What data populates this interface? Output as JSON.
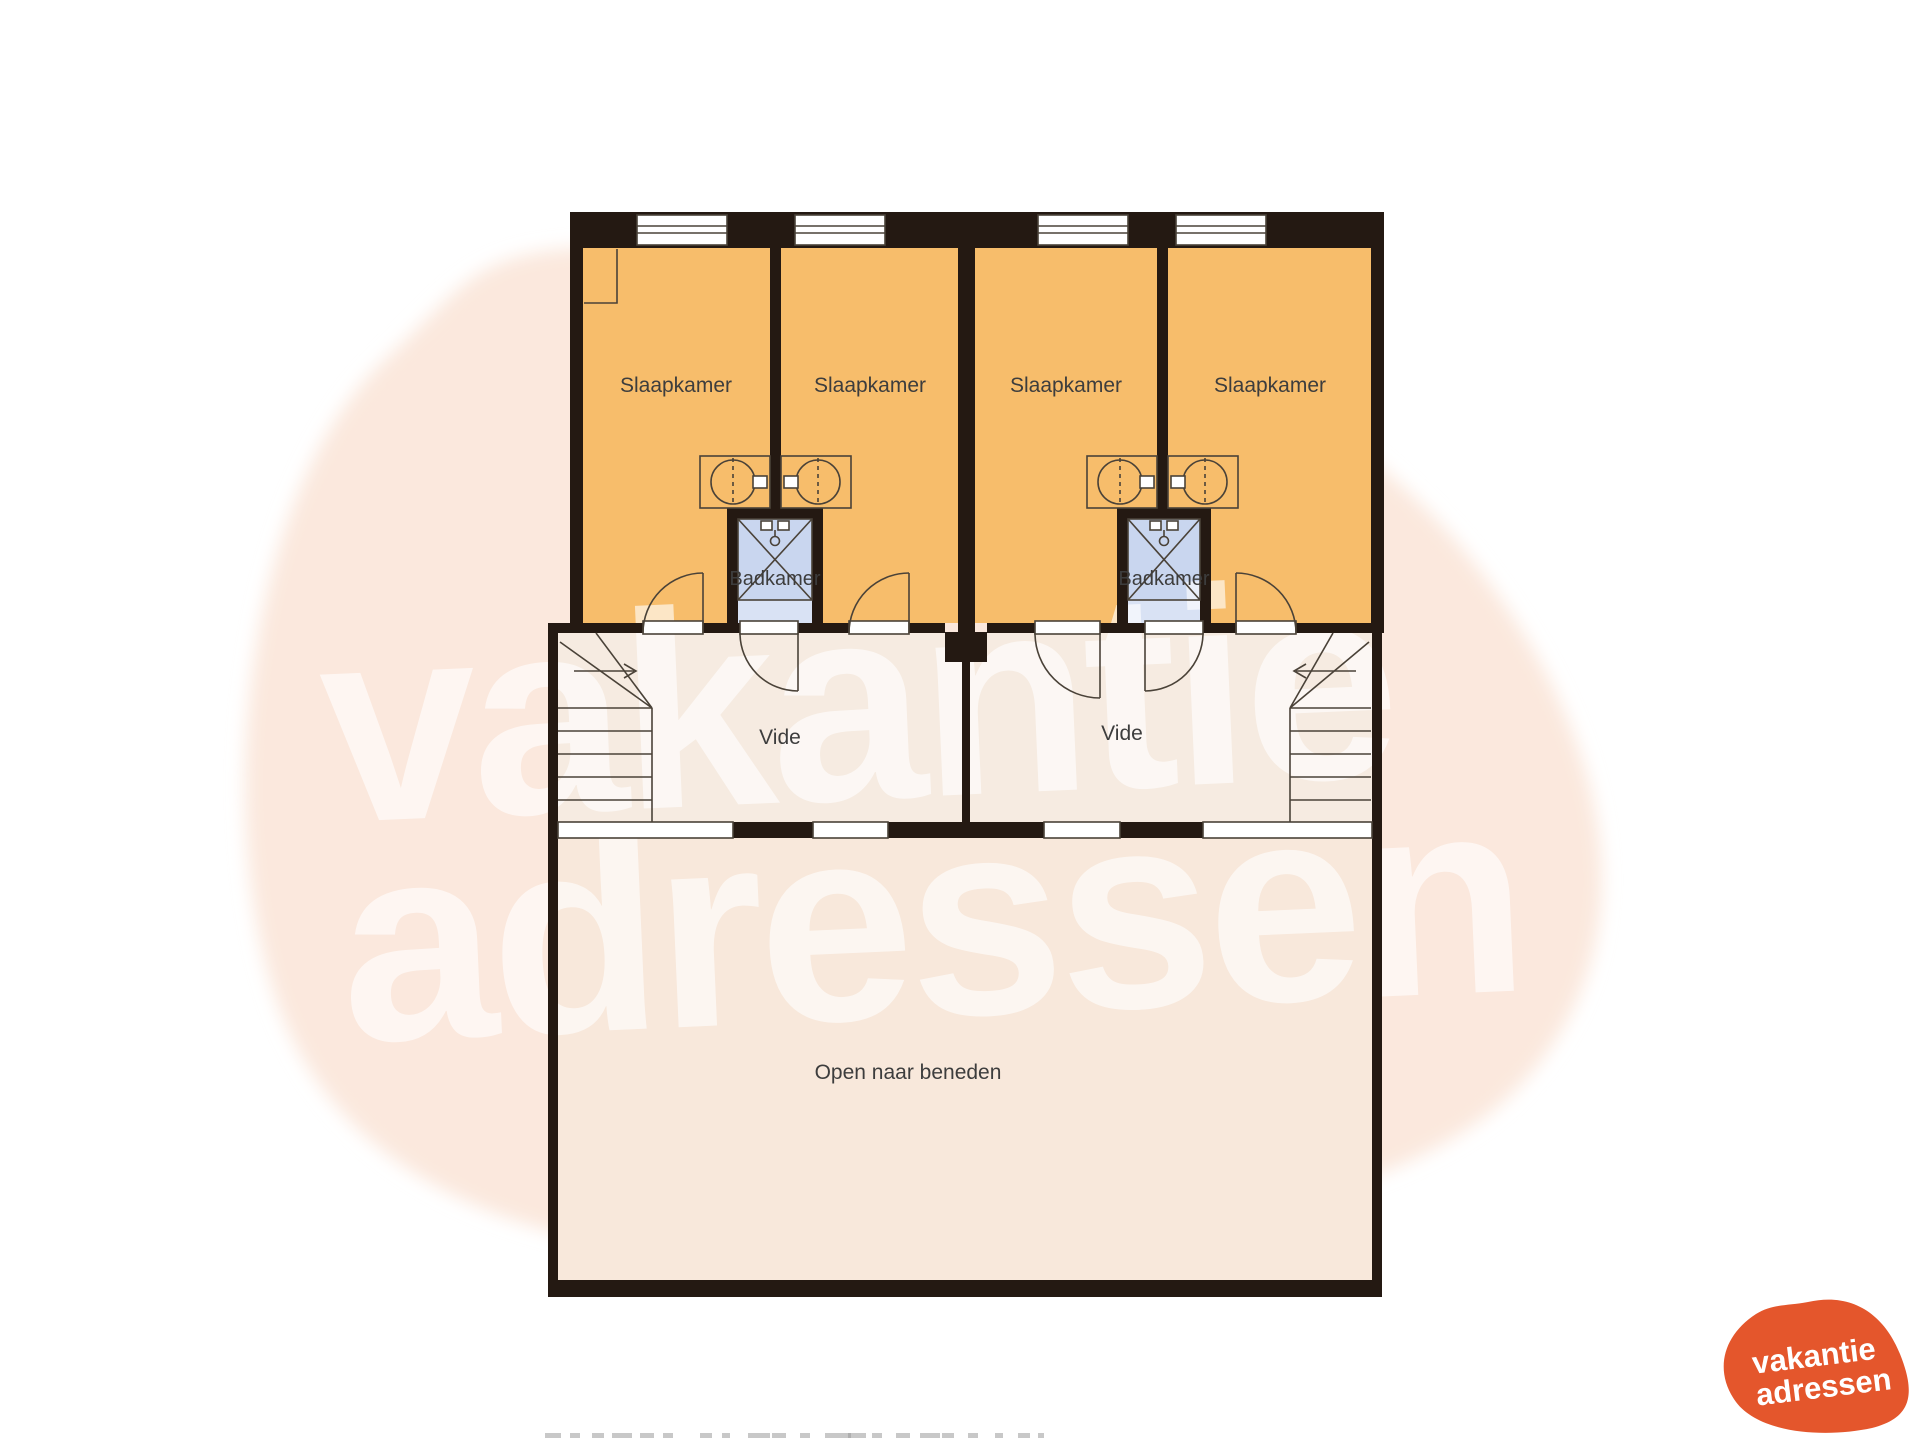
{
  "floorplan": {
    "rooms": {
      "slaapkamer": "Slaapkamer",
      "badkamer": "Badkamer",
      "vide": "Vide",
      "open_naar_beneden": "Open naar beneden"
    }
  },
  "watermark": {
    "line1": "vakantie",
    "line2": "adressen"
  },
  "logo": {
    "line1": "vakantie",
    "line2": "adressen"
  },
  "colors": {
    "wall": "#241912",
    "bedroom_floor": "#F7BD6B",
    "bathroom_floor": "#C9D6EF",
    "bathroom_floor_light": "#D9E2F4",
    "landing_floor": "#F6EBE1",
    "open_floor": "#F8E8DB",
    "background_blob": "#FBE8DD",
    "logo_orange": "#E4562C",
    "label_text": "#3D3D3D"
  },
  "footer": {
    "dashes": [
      {
        "x": 545,
        "w": 16
      },
      {
        "x": 570,
        "w": 10
      },
      {
        "x": 592,
        "w": 12
      },
      {
        "x": 612,
        "w": 20
      },
      {
        "x": 640,
        "w": 14
      },
      {
        "x": 663,
        "w": 10
      },
      {
        "x": 700,
        "w": 12
      },
      {
        "x": 722,
        "w": 8
      },
      {
        "x": 748,
        "w": 22
      },
      {
        "x": 772,
        "w": 14
      },
      {
        "x": 800,
        "w": 10
      },
      {
        "x": 825,
        "w": 26
      },
      {
        "x": 848,
        "w": 18
      },
      {
        "x": 872,
        "w": 10
      },
      {
        "x": 896,
        "w": 14
      },
      {
        "x": 920,
        "w": 20
      },
      {
        "x": 942,
        "w": 12
      },
      {
        "x": 968,
        "w": 10
      },
      {
        "x": 995,
        "w": 8
      },
      {
        "x": 1018,
        "w": 12
      },
      {
        "x": 1038,
        "w": 6
      }
    ]
  }
}
